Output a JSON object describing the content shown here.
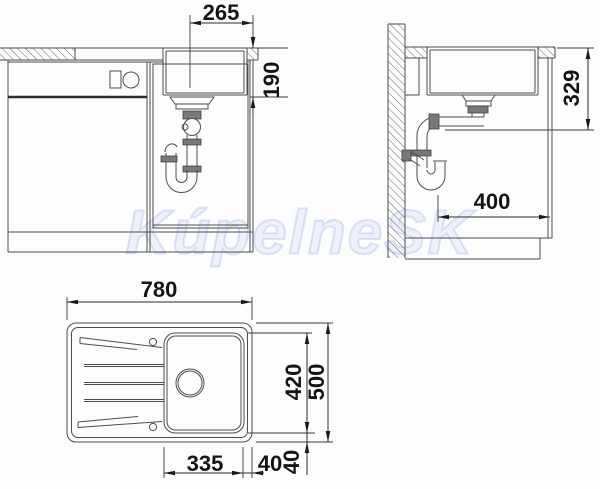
{
  "watermark": "KúpelneSK",
  "front_view": {
    "dims": {
      "drain_center_to_edge": "265",
      "bowl_depth": "190"
    }
  },
  "side_view": {
    "dims": {
      "worktop_to_outlet": "329",
      "rear_clearance": "400"
    }
  },
  "plan_view": {
    "dims": {
      "overall_width": "780",
      "bowl_length": "420",
      "overall_depth": "500",
      "bowl_width": "335",
      "edge_offset_bottom": "40",
      "edge_offset_right": "40"
    }
  },
  "colors": {
    "line": "#4d4d4d",
    "dimension_text": "#141414",
    "watermark": "#c3cfee",
    "background": "#fdfdfd"
  }
}
